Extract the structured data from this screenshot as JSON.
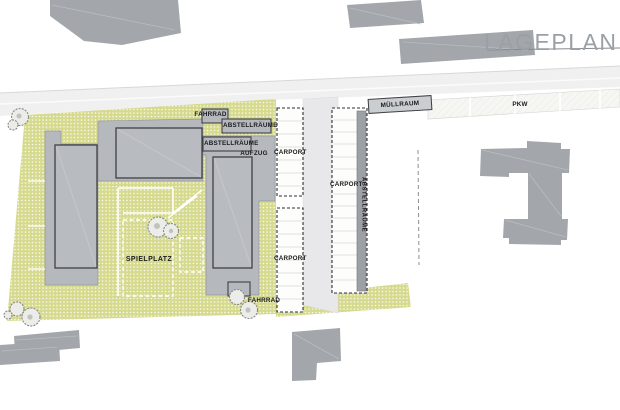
{
  "title": "LAGEPLAN",
  "site": {
    "labels": {
      "fahrrad_top": "FAHRRAD",
      "abstellraeume_top": "ABSTELLRÄUME",
      "abstellraeume_mid": "ABSTELLRÄUME",
      "aufzug": "AUFZUG",
      "carport_left_top": "CARPORT",
      "carport_left_bottom": "CARPORT",
      "carport_right": "CARPORT",
      "abstellraeume_vertical": "ABSTELLRÄUME",
      "spielplatz": "SPIELPLATZ",
      "fahrrad_bottom": "FAHRRAD"
    },
    "street_labels": {
      "muellraum": "MÜLLRAUM",
      "pkw": "PKW"
    }
  },
  "colors": {
    "site_green": "#d6da8e",
    "building_gray": "#b5b8bd",
    "neighbor_gray": "#a3a7ab",
    "street_gray": "#f0f0f1",
    "driveway_gray": "#e8e8ea",
    "outline_dark": "#3f4045",
    "title_gray": "#9aa0a6",
    "carport_white": "#fdfdfc"
  }
}
